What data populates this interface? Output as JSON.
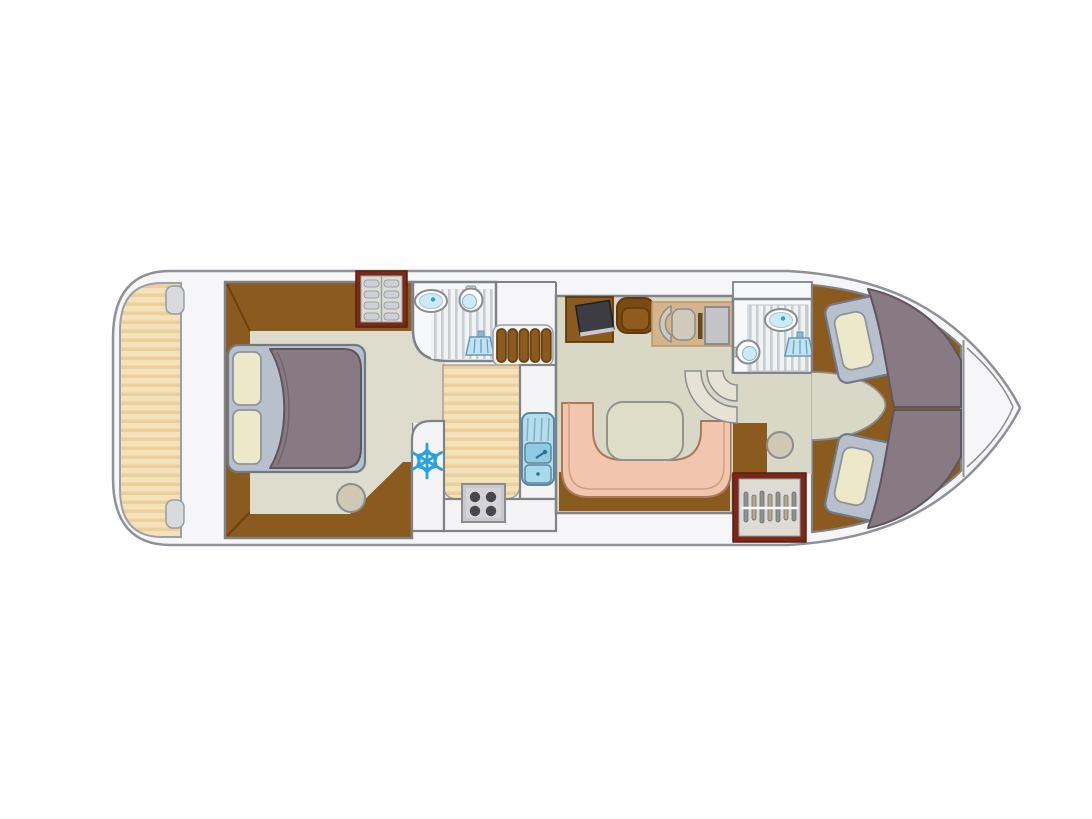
{
  "diagram": {
    "type": "boat-floor-plan",
    "view": "top-down deck plan",
    "description": "Top-view interior layout plan of a canal cruiser houseboat: aft sun deck, master cabin with double bed and wardrobe, aft bathroom with washbasin, toilet and shower, galley with refrigerator, four-burner stove and double sink, saloon with TV, armchair, helm station and U-shaped dinette with table, forward bathroom, forward wardrobe, two forward V-berths and bow deck."
  },
  "colors": {
    "hull": "#f6f6f8",
    "outline": "#8e9196",
    "wall": "#7f8287",
    "deck-light": "#f5e2ba",
    "deck-dark": "#ebcf9d",
    "floor": "#d9d8c7",
    "carpet": "#deddcd",
    "wood": "#8a5a1e",
    "wood-dark": "#6b4210",
    "bedframe": "#b7c0cc",
    "bedframe-stroke": "#6f7a85",
    "pillow": "#eee8cb",
    "blanket": "#877a83",
    "blanket-stroke": "#5f5560",
    "water": "#cfeaf5",
    "accent-blue": "#2aa3dd",
    "counter": "#f4f4f6",
    "sink-unit": "#b5dcec",
    "stove": "#c9c9cd",
    "burner": "#46464c",
    "bench": "#f2c6ae",
    "bench-stroke": "#a9795a",
    "table": "#deddc8",
    "wardrobe": "#7a2817",
    "wardrobe-inner": "#dcdcd2",
    "mat": "#d3b48c",
    "tv": "#3c3c43",
    "chair": "#cfcabb",
    "stool": "#cfc8b4"
  },
  "rooms": [
    {
      "id": "aft-deck",
      "label": "Aft deck"
    },
    {
      "id": "master-cabin",
      "label": "Master cabin"
    },
    {
      "id": "bathroom-aft",
      "label": "Aft bathroom"
    },
    {
      "id": "galley",
      "label": "Galley"
    },
    {
      "id": "saloon",
      "label": "Saloon with dinette"
    },
    {
      "id": "helm",
      "label": "Helm station"
    },
    {
      "id": "bathroom-fwd",
      "label": "Forward bathroom"
    },
    {
      "id": "bow-cabin",
      "label": "Forward cabin with V-berths"
    },
    {
      "id": "bow-deck",
      "label": "Bow deck"
    }
  ],
  "inventory": {
    "double_beds": 1,
    "single_berths": 2,
    "bathrooms": 2,
    "washbasins": 2,
    "toilets": 2,
    "showers": 2,
    "stove_burners": 4,
    "kitchen_sink_basins": 2,
    "refrigerators": 1,
    "dinette_tables": 1,
    "u_shaped_benches": 1,
    "wardrobes": 2,
    "stools": 2,
    "tv_sets": 1,
    "helm_seats": 1,
    "stairways": 2
  }
}
